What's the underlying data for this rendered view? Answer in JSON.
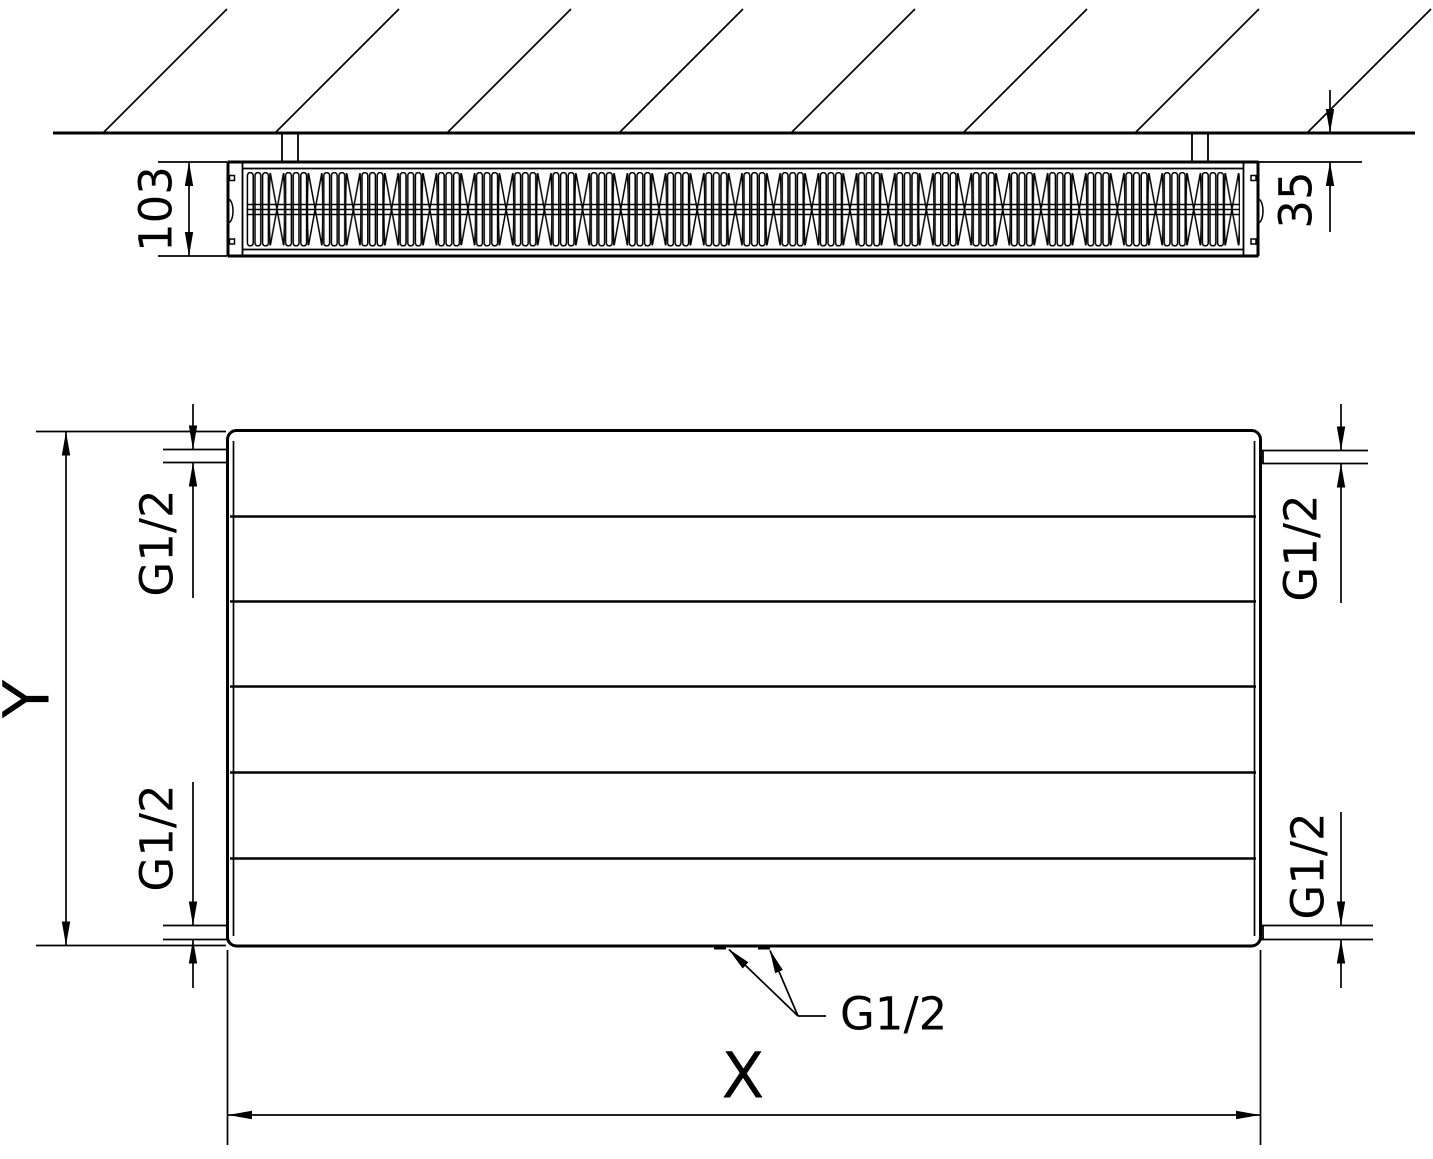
{
  "meta": {
    "background_color": "#ffffff",
    "line_color": "#000000",
    "drawing_type": "radiator dimension diagram"
  },
  "top_view": {
    "depth_dim": "103",
    "wall_gap_dim": "35"
  },
  "front_view": {
    "height_dim": "Y",
    "width_dim": "X",
    "connections": {
      "top_left": "G1/2",
      "bottom_left": "G1/2",
      "top_right": "G1/2",
      "bottom_right": "G1/2",
      "bottom_center": "G1/2"
    }
  }
}
